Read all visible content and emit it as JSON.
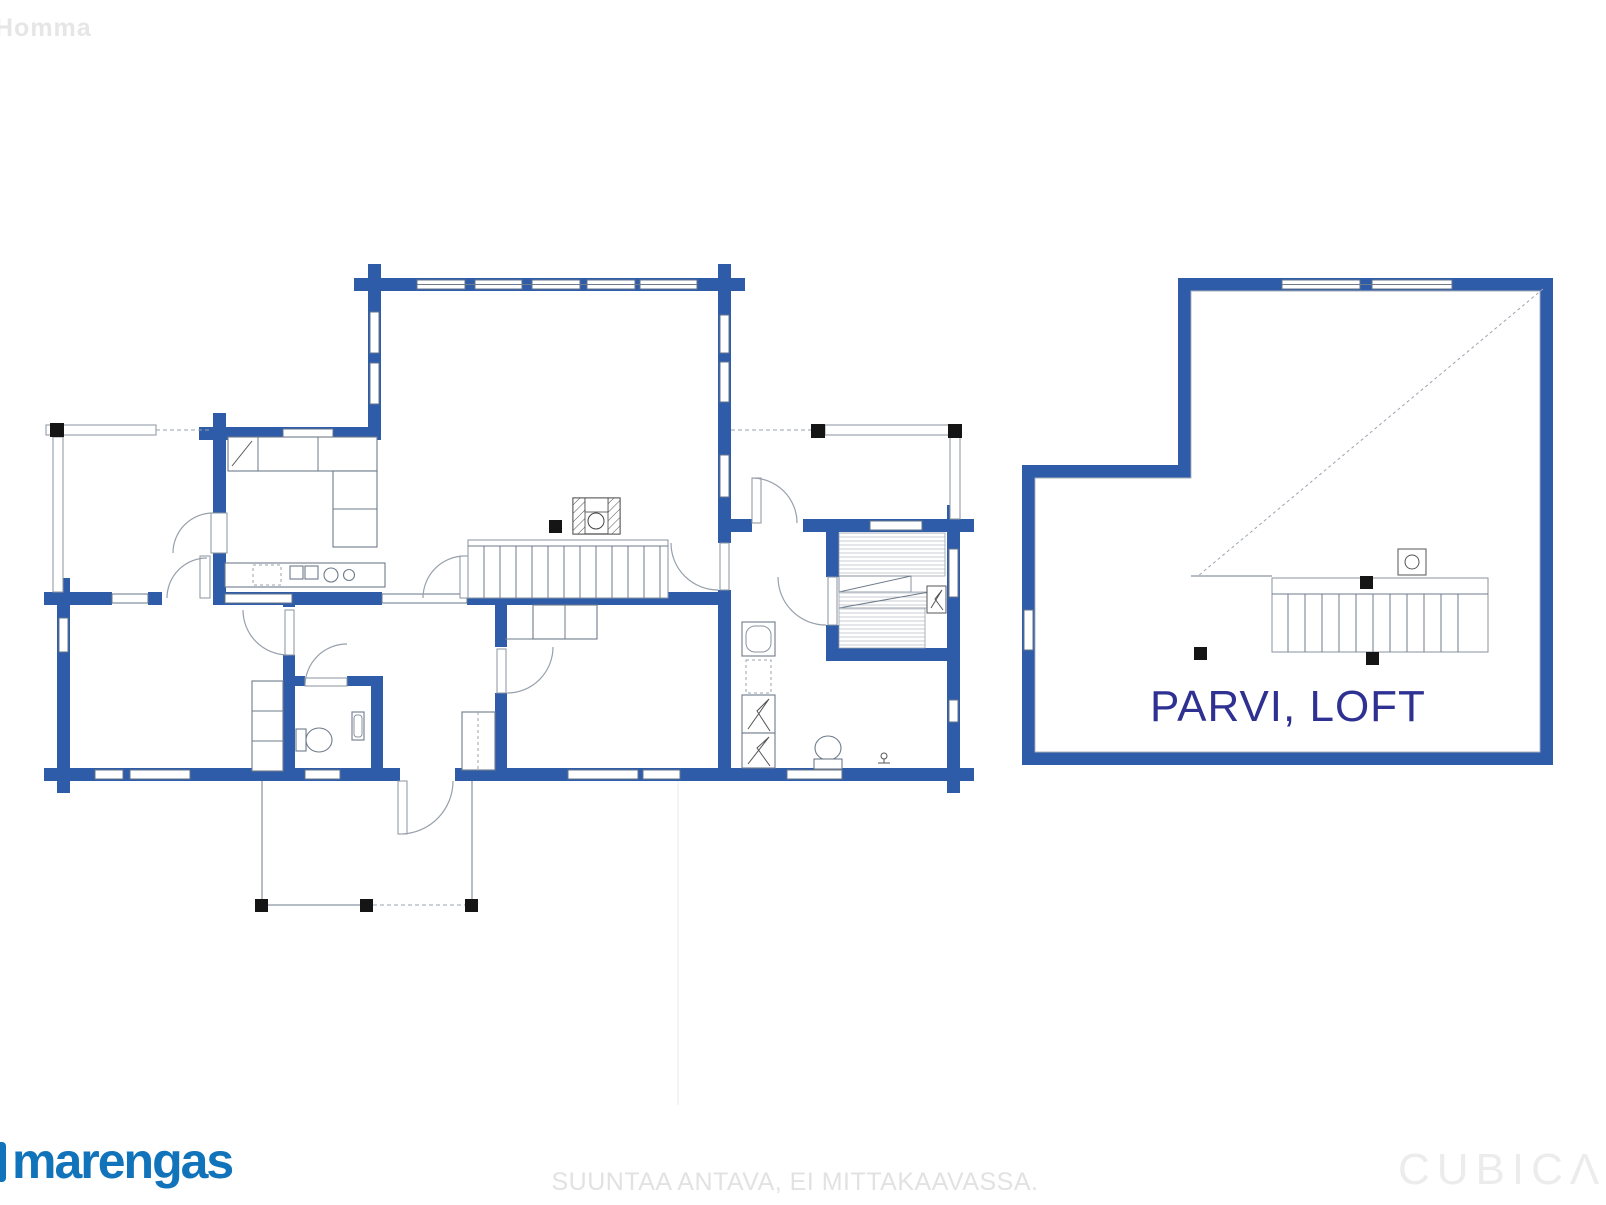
{
  "colors": {
    "wall_blue": "#2e5ca8",
    "loft_label_navy": "#2e3192",
    "logo_blue": "#1173b9",
    "disclaimer_gray": "#e2e2e2",
    "cubica_gray": "#ececec"
  },
  "watermarks": {
    "top_left": "Homma",
    "bottom_center_disclaimer": "SUUNTAA ANTAVA, EI MITTAKAAVASSA.",
    "bottom_right_brand": "CUBICΛ"
  },
  "branding": {
    "logo_text": "marengas"
  },
  "loft": {
    "label": "PARVI, LOFT"
  }
}
